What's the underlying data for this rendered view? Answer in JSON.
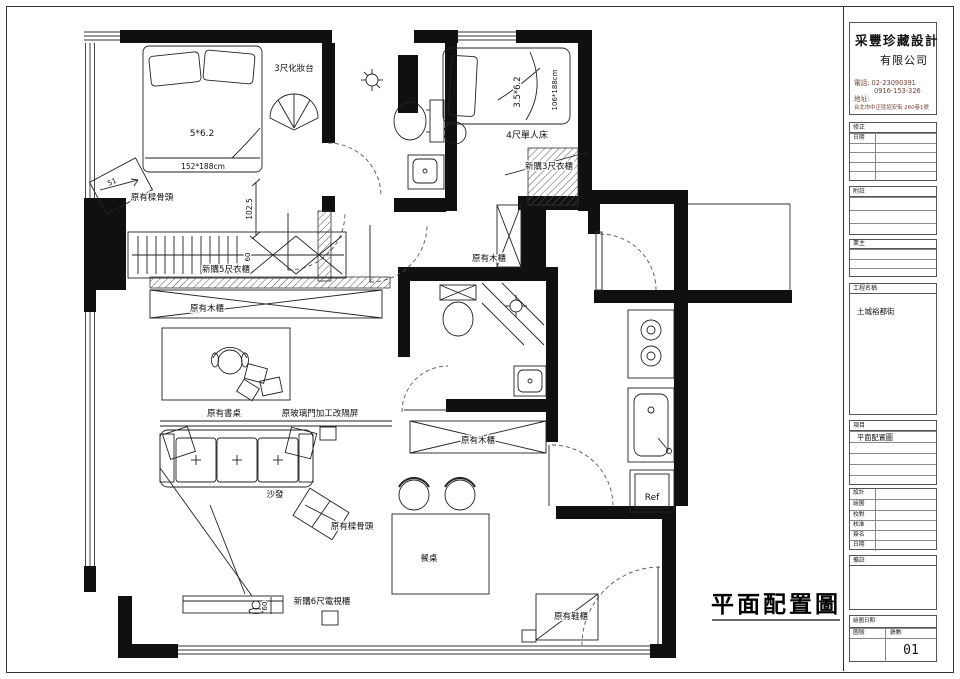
{
  "plan": {
    "big_title": "平面配置圖",
    "rooms": {
      "bed1_size": "5*6.2",
      "bed1_dim": "152*188cm",
      "dresser": "3尺化妝台",
      "beam_marker": "原有樑骨頭",
      "beam_tag": "51",
      "dim_height": "102.5",
      "dim_60": "60",
      "wardrobe_5ft": "新購5尺衣櫃",
      "wood_cabinet": "原有木櫃",
      "desk": "原有書桌",
      "glass_partition": "原玻璃門加工改隔屏",
      "sofa": "沙發",
      "tv_cabinet_6ft": "新購6尺電視櫃",
      "dining_table": "餐桌",
      "shoe_cabinet": "原有鞋櫃",
      "bed2_size": "3.5*6.2",
      "bed2_dim": "106*188cm",
      "single_bed_4ft": "4尺單人床",
      "wardrobe_3ft": "新購3尺衣櫃",
      "fridge": "Ref"
    }
  },
  "title_block": {
    "company_name": "采豐珍藏設計",
    "company_suffix": "有限公司",
    "phone_label": "電話:",
    "phone_1": "02-23090391",
    "phone_2": "0916-153-326",
    "address_label": "地址:",
    "address": "台北市中正區詔安街 260巷1號",
    "revision_label": "修正",
    "date_label": "日期",
    "notes_label": "附註",
    "client_label": "業主",
    "project_label": "工程名稱",
    "project_name": "土城裕都街",
    "item_label": "項目",
    "item_value": "平面配置圖",
    "sign_rows": [
      "設計",
      "繪圖",
      "校對",
      "核准",
      "簽名",
      "日期"
    ],
    "remarks_label": "備註",
    "draw_date_label": "繪圖日期",
    "sheet_no_label": "圖號",
    "sheet_count_label": "張數",
    "sheet_number": "01"
  }
}
